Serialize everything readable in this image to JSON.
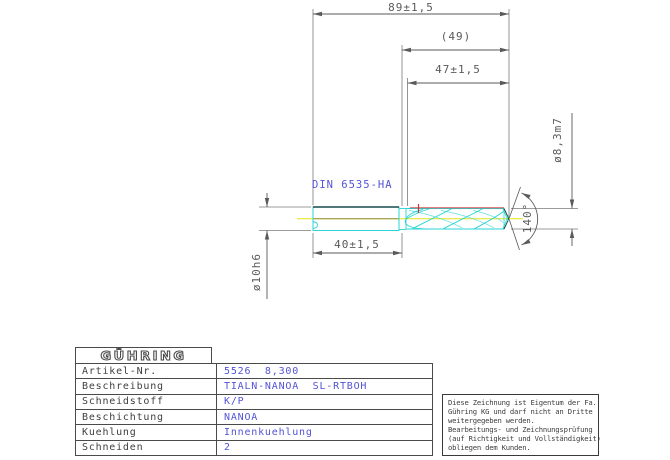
{
  "drawing": {
    "dim_overall_length": "89±1,5",
    "dim_flute_ref": "(49)",
    "dim_flute_length": "47±1,5",
    "dim_shank_length": "40±1,5",
    "dim_shank_diameter": "ø10h6",
    "dim_cutting_diameter": "ø8,3m7",
    "point_angle": "140°",
    "shank_standard": "DIN  6535-HA",
    "colors": {
      "dimension_gray": "#5a5a5a",
      "annotation_blue": "#5353d6",
      "flute_cyan": "#2ad4d4",
      "centerline_yellow": "#e3e312",
      "centerline_olive": "#8f8f4a",
      "coolant_red": "#cc3333",
      "shank_dark_teal": "#174b4b"
    }
  },
  "title_block": {
    "logo_text": "GÜHRING",
    "rows": [
      {
        "label": "Artikel-Nr.",
        "value": "5526  8,300"
      },
      {
        "label": "Beschreibung",
        "value": "TIALN-NANOA  SL-RTBOH"
      },
      {
        "label": "Schneidstoff",
        "value": "K/P"
      },
      {
        "label": "Beschichtung",
        "value": "NANOA"
      },
      {
        "label": "Kuehlung",
        "value": "Innenkuehlung"
      },
      {
        "label": "Schneiden",
        "value": "2"
      }
    ]
  },
  "disclaimer": {
    "lines": [
      "Diese Zeichnung ist Eigentum der Fa.",
      "Gühring KG und darf nicht an Dritte",
      "weitergegeben werden.",
      "Bearbeitungs- und Zeichnungsprüfung",
      "(auf Richtigkeit und Vollständigkeit)",
      "obliegen dem Kunden."
    ]
  }
}
